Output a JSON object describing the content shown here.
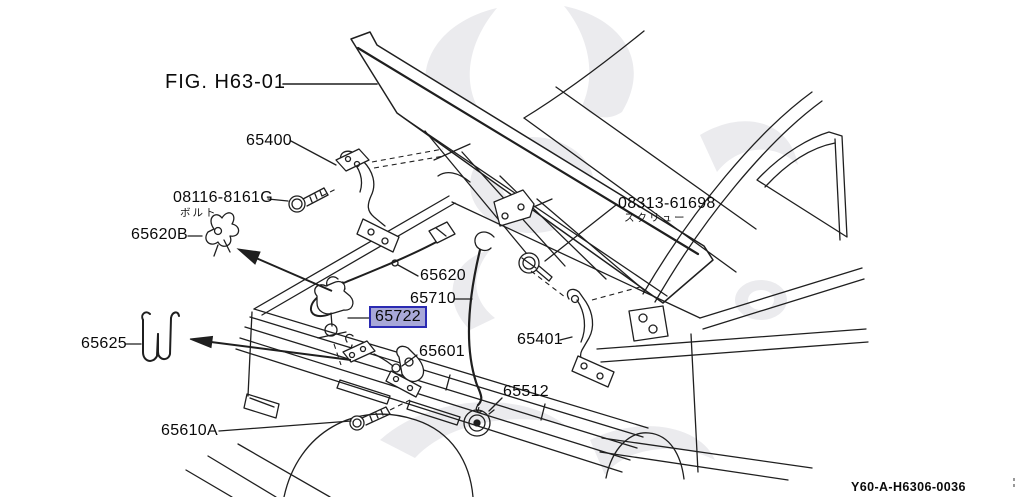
{
  "diagram": {
    "fig_ref": "FIG. H63-01",
    "doc_ref": "Y60-A-H6306-0036",
    "selected_part": "65722",
    "highlight": {
      "fill": "#a8a8d8",
      "border": "#2a2ab2"
    },
    "colors": {
      "line": "#1f1f1f",
      "background": "#ffffff",
      "watermark": "#ebebee"
    },
    "labels": {
      "l65400": "65400",
      "l08116": "08116-8161G",
      "l08116_sub": "ボルト",
      "l65620b": "65620B",
      "l65620": "65620",
      "l65710": "65710",
      "l65722": "65722",
      "l65601": "65601",
      "l65401": "65401",
      "l08313": "08313-61698",
      "l08313_sub": "スクリュー",
      "l65512": "65512",
      "l65625": "65625",
      "l65610a": "65610A"
    }
  }
}
